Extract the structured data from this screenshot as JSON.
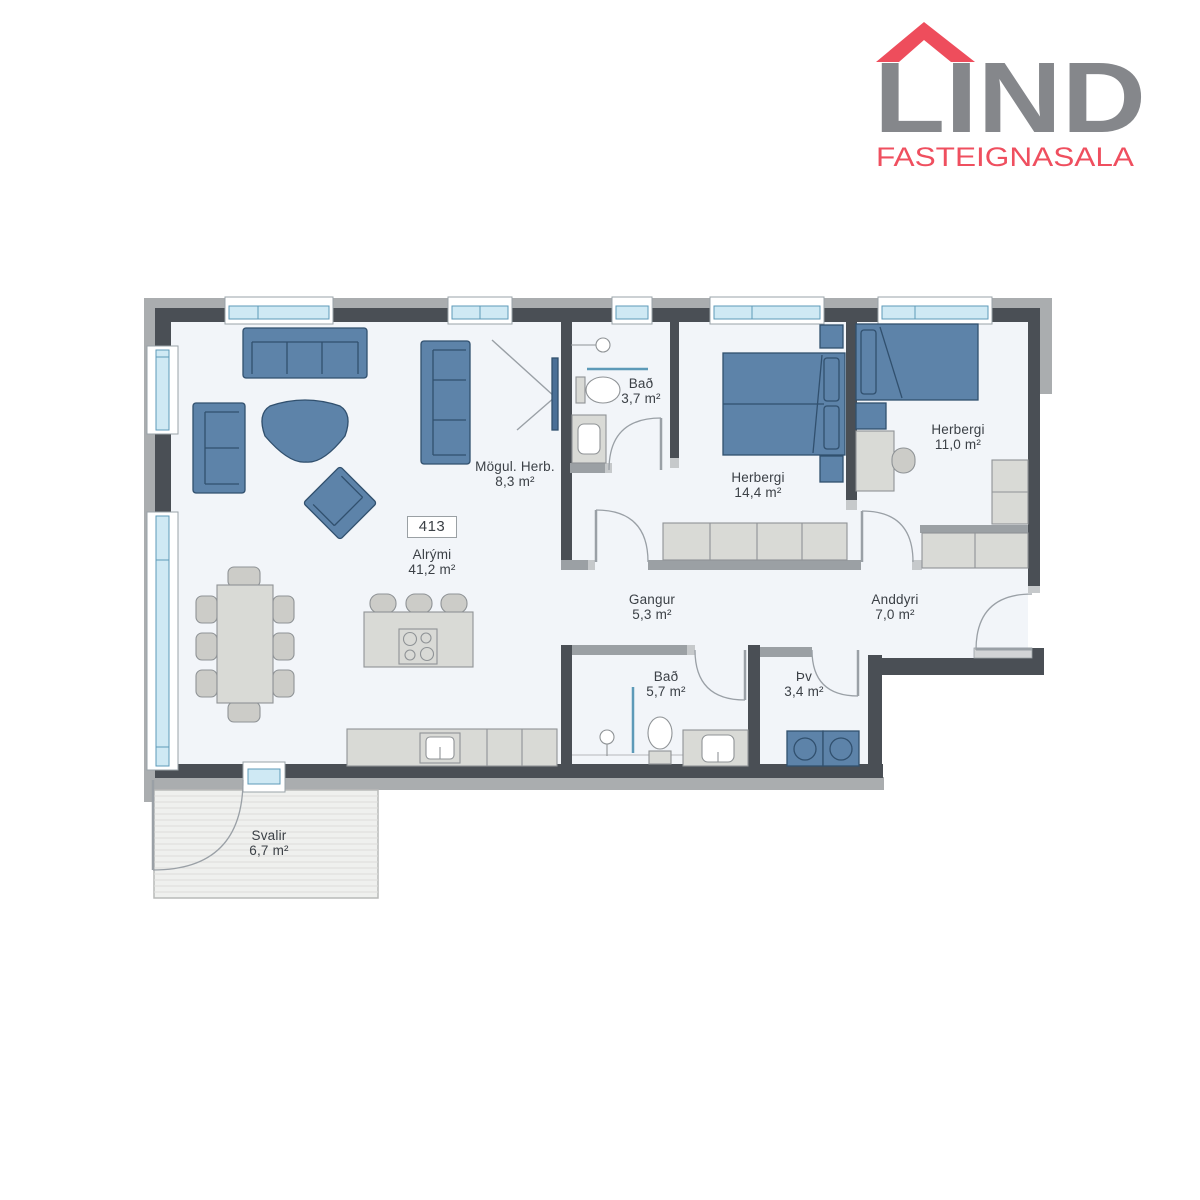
{
  "logo": {
    "name": "LIND",
    "subtitle": "FASTEIGNASALA"
  },
  "unit_number": "413",
  "rooms": [
    {
      "id": "alrymi",
      "name": "Alrými",
      "area": "41,2 m²"
    },
    {
      "id": "mogul-herb",
      "name": "Mögul. Herb.",
      "area": "8,3 m²"
    },
    {
      "id": "bad-small",
      "name": "Bað",
      "area": "3,7 m²"
    },
    {
      "id": "herbergi-14-4",
      "name": "Herbergi",
      "area": "14,4 m²"
    },
    {
      "id": "herbergi-11-0",
      "name": "Herbergi",
      "area": "11,0 m²"
    },
    {
      "id": "gangur",
      "name": "Gangur",
      "area": "5,3 m²"
    },
    {
      "id": "anddyri",
      "name": "Anddyri",
      "area": "7,0 m²"
    },
    {
      "id": "bad-large",
      "name": "Bað",
      "area": "5,7 m²"
    },
    {
      "id": "thvottahus",
      "name": "Þv",
      "area": "3,4 m²"
    },
    {
      "id": "svalir",
      "name": "Svalir",
      "area": "6,7 m²"
    }
  ],
  "colors": {
    "wall_dark": "#4a4f55",
    "wall_light": "#9ba0a4",
    "wall_cap": "#c6c9cb",
    "outer_band": "#aaadaf",
    "floor": "#f2f5f9",
    "furniture_blue": "#5d83a9",
    "furniture_blue_line": "#31506e",
    "furniture_gray": "#d9dad6",
    "window_glass": "#cfe9f4",
    "window_glass_line": "#5d9ab8",
    "door_line": "#9aa0a6",
    "balcony_deck": "#eff0ee",
    "logo_gray": "#85878b",
    "logo_red": "#ef4f5f",
    "label_text": "#3b4046"
  }
}
